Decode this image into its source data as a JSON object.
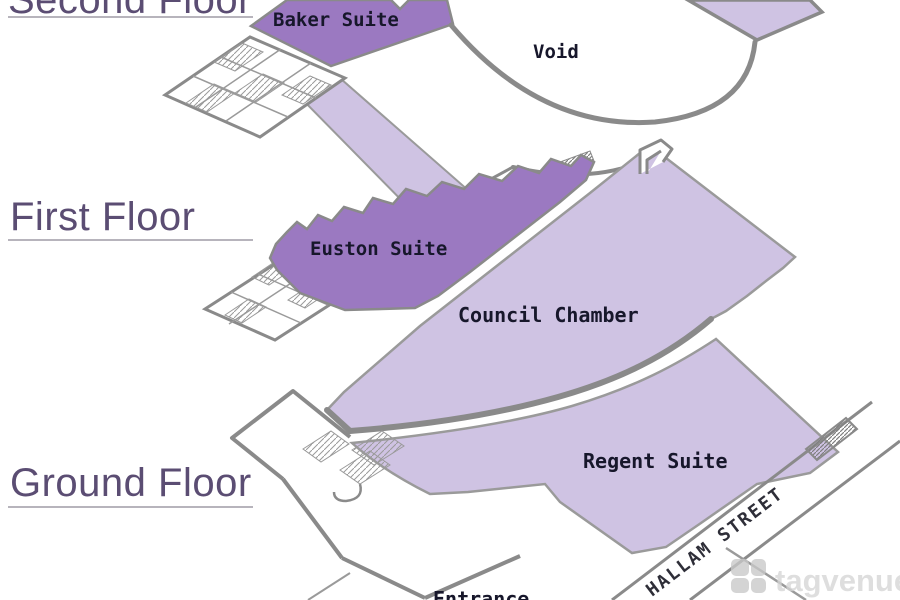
{
  "page": {
    "type": "isometric-floor-plan",
    "watermark": {
      "brand": "tagvenue"
    }
  },
  "floors": [
    {
      "label": "Second Floor",
      "rooms": [
        {
          "name": "Baker Suite"
        },
        {
          "name": "Void"
        }
      ]
    },
    {
      "label": "First Floor",
      "rooms": [
        {
          "name": "Euston Suite"
        },
        {
          "name": "Council Chamber"
        }
      ]
    },
    {
      "label": "Ground Floor",
      "rooms": [
        {
          "name": "Regent Suite"
        },
        {
          "name": "Entrance"
        }
      ]
    }
  ],
  "street": {
    "name": "HALLAM STREET"
  },
  "colors": {
    "room_purple": "#9b79c1",
    "room_light_purple": "#cfc3e3",
    "outline_gray": "#8a8a8a",
    "heading_purple": "#5b4d73",
    "label_ink": "#17172b",
    "watermark_gray": "#d6d6d6"
  }
}
